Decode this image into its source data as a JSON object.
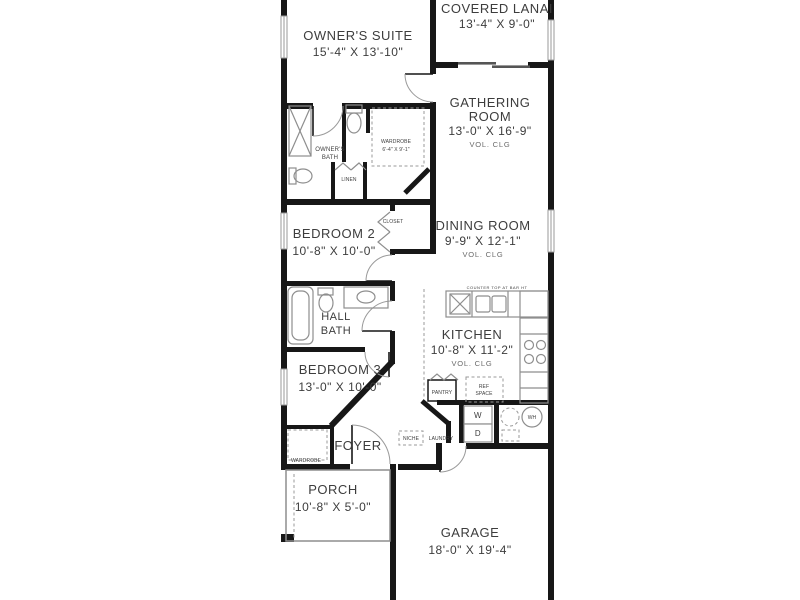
{
  "rooms": {
    "owners_suite": {
      "name": "OWNER'S SUITE",
      "dims": "15'-4\" X 13'-10\""
    },
    "covered_lanai": {
      "name": "COVERED LANAI",
      "dims": "13'-4\" X 9'-0\""
    },
    "gathering_room": {
      "name1": "GATHERING",
      "name2": "ROOM",
      "dims": "13'-0\" X 16'-9\"",
      "note": "VOL. CLG"
    },
    "owners_bath": {
      "name1": "OWNER'S",
      "name2": "BATH"
    },
    "owners_wardrobe": {
      "name": "WARDROBE",
      "dims": "6'-4\" X 9'-1\""
    },
    "linen": {
      "name": "LINEN"
    },
    "bedroom2": {
      "name": "BEDROOM 2",
      "dims": "10'-8\" X 10'-0\""
    },
    "closet": {
      "name": "CLOSET"
    },
    "dining_room": {
      "name": "DINING ROOM",
      "dims": "9'-9\" X 12'-1\"",
      "note": "VOL. CLG"
    },
    "hall_bath": {
      "name1": "HALL",
      "name2": "BATH"
    },
    "kitchen": {
      "name": "KITCHEN",
      "dims": "10'-8\" X 11'-2\"",
      "note": "VOL. CLG"
    },
    "ref_space": {
      "name1": "REF",
      "name2": "SPACE"
    },
    "pantry": {
      "name": "PANTRY"
    },
    "bedroom3": {
      "name": "BEDROOM 3",
      "dims": "13'-0\" X 10'-0\""
    },
    "foyer": {
      "name": "FOYER"
    },
    "niche": {
      "name": "NICHE"
    },
    "laundry": {
      "name": "LAUNDRY"
    },
    "foyer_wardrobe": {
      "name": "WARDROBE"
    },
    "porch": {
      "name": "PORCH",
      "dims": "10'-8\" X 5'-0\""
    },
    "garage": {
      "name": "GARAGE",
      "dims": "18'-0\" X 19'-4\""
    }
  },
  "appliances": {
    "washer": "W",
    "dryer": "D",
    "water_heater": "WH"
  },
  "annotations": {
    "kitchen_counter": "COUNTER TOP AT BAR HT"
  },
  "colors": {
    "wall": "#171717",
    "fixture_line": "#8e8e8e",
    "text": "#3d3d3d",
    "background": "#ffffff"
  }
}
